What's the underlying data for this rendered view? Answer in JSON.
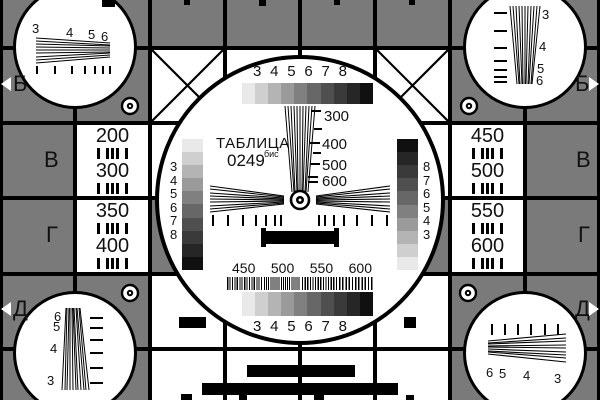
{
  "colors": {
    "background": "#7a7a7a",
    "grid_line": "#000000",
    "panel": "#ffffff",
    "ink": "#111111"
  },
  "grayscale_steps": [
    "#e9e9e9",
    "#cfcfcf",
    "#b4b4b4",
    "#9a9a9a",
    "#808080",
    "#676767",
    "#4f4f4f",
    "#3a3a3a",
    "#262626",
    "#101010"
  ],
  "title": {
    "word": "ТАБЛИЦА",
    "number": "0249",
    "suffix": "бис"
  },
  "big_circle": {
    "top_digits": [
      "3",
      "4",
      "5",
      "6",
      "7",
      "8"
    ],
    "bottom_digits": [
      "3",
      "4",
      "5",
      "6",
      "7",
      "8"
    ],
    "side_scale_digits": [
      "3",
      "4",
      "5",
      "6",
      "7",
      "8"
    ],
    "wedge_labels": [
      "300",
      "400",
      "500",
      "600"
    ],
    "burst_labels": [
      "450",
      "500",
      "550",
      "600"
    ]
  },
  "side_panels": {
    "left_top": {
      "v1": "200",
      "v2": "300"
    },
    "left_bottom": {
      "v1": "350",
      "v2": "400"
    },
    "right_top": {
      "v1": "450",
      "v2": "500"
    },
    "right_bottom": {
      "v1": "550",
      "v2": "600"
    }
  },
  "edge_letters": {
    "row2": "Б",
    "row3": "В",
    "row4": "Г",
    "row5": "Д"
  },
  "corner_wedges": {
    "digits": [
      "3",
      "4",
      "5",
      "6"
    ]
  }
}
